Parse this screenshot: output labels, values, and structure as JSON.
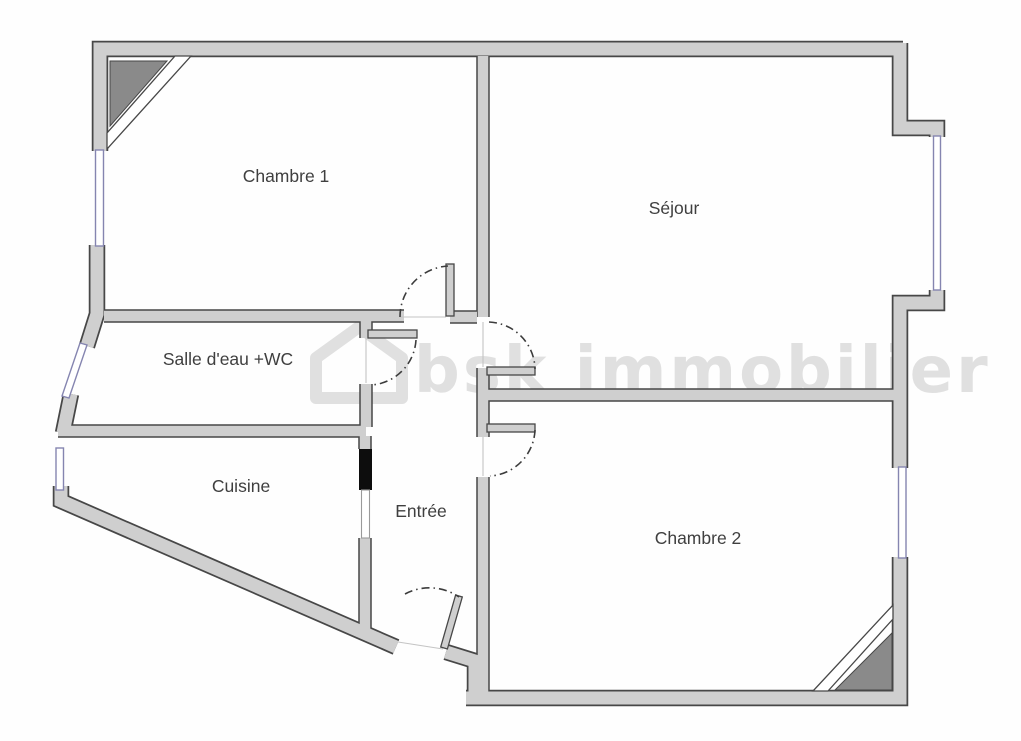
{
  "plan": {
    "title": "Apartment floor plan",
    "rooms": [
      {
        "id": "chambre-1",
        "label": "Chambre 1"
      },
      {
        "id": "sejour",
        "label": "Séjour"
      },
      {
        "id": "salle-deau-wc",
        "label": "Salle d'eau +WC"
      },
      {
        "id": "cuisine",
        "label": "Cuisine"
      },
      {
        "id": "entree",
        "label": "Entrée"
      },
      {
        "id": "chambre-2",
        "label": "Chambre 2"
      }
    ],
    "watermark": {
      "text": "bsk immobilier",
      "icon": "house-icon"
    },
    "colors": {
      "background": "#fefefe",
      "wall_fill": "#cfcfcf",
      "wall_stroke": "#474747",
      "dark_corner": "#8a8a8a",
      "window_stroke": "#8585b0",
      "window_fill": "#ffffff",
      "black_door": "#0d0d0d",
      "label": "#3f3f3f",
      "arc": "#3c3c3c",
      "faint_line": "#c4c4c4",
      "watermark": "#e0e0e0"
    }
  }
}
